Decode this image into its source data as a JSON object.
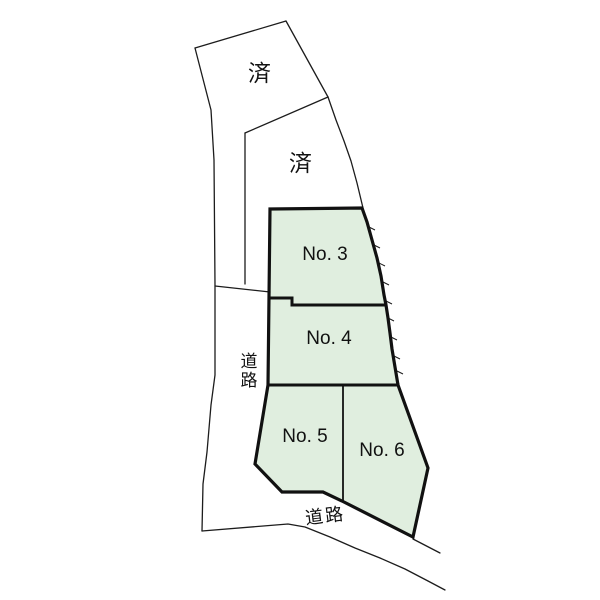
{
  "diagram": {
    "lots": {
      "sold_upper": {
        "label": "済"
      },
      "sold_lower": {
        "label": "済"
      },
      "no3": {
        "label": "No. 3"
      },
      "no4": {
        "label": "No. 4"
      },
      "no5": {
        "label": "No. 5"
      },
      "no6": {
        "label": "No. 6"
      }
    },
    "roads": {
      "left": {
        "label": "道路"
      },
      "bottom": {
        "label": "道路"
      }
    },
    "colors": {
      "lot_fill": "#e0eedf",
      "line": "#1c1c1c",
      "background": "#ffffff"
    }
  }
}
